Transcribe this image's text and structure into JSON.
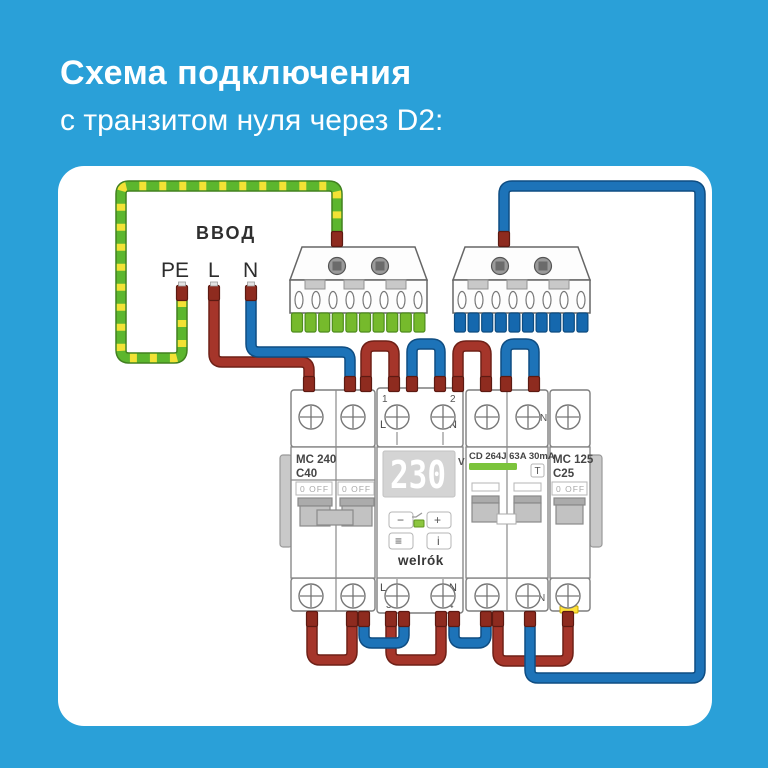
{
  "background_color": "#2aa0d8",
  "header": {
    "title": "Схема подключения",
    "subtitle": "с транзитом нуля через D2:"
  },
  "diagram": {
    "input": {
      "label": "ВВОД",
      "pe": "PE",
      "l": "L",
      "n": "N"
    },
    "wire_colors": {
      "phase": "#a5352a",
      "neutral": "#1d73b8",
      "pe_green": "#5cb62e",
      "pe_yellow": "#f2e235",
      "ferrule": "#8e2b1f"
    },
    "busbars": {
      "pe_teeth": "#76ba2c",
      "n_teeth": "#1568ae"
    },
    "devices": {
      "main_breaker": {
        "model": "MC 240",
        "curve": "C40",
        "state_label": "0 OFF"
      },
      "voltage_relay": {
        "brand": "welrók",
        "display": {
          "value": "230",
          "unit": "V"
        },
        "buttons": {
          "minus": "−",
          "plus": "+",
          "menu": "≡",
          "info": "i"
        },
        "terminals": {
          "t1": "1",
          "t2": "2",
          "t3": "3",
          "t4": "4",
          "l": "L",
          "n": "N"
        },
        "led_color": "#8cc63f"
      },
      "rcd": {
        "label": "CD 264J 63A 30mA",
        "test_button": "T",
        "n_label": "N",
        "stripe_color": "#7cc43c"
      },
      "line_breaker": {
        "model": "MC 125",
        "curve": "C25",
        "state_label": "0 OFF",
        "marker_color": "#ffe13a"
      }
    }
  }
}
